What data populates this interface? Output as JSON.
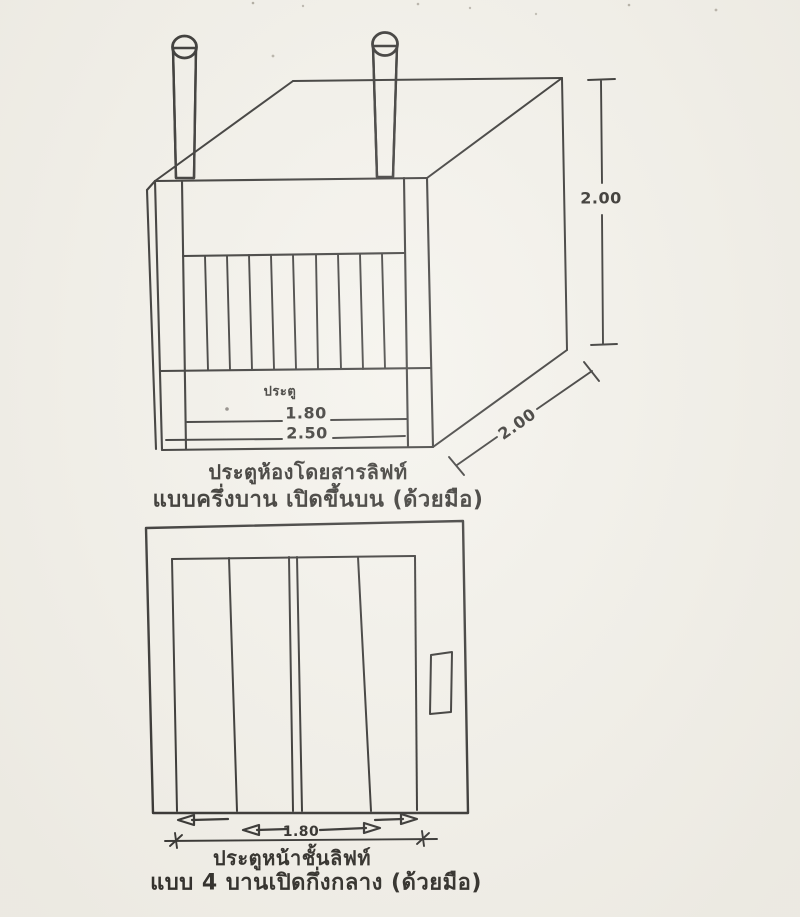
{
  "page": {
    "paper_color": "#f3f1ea",
    "ink_color": "#2b2a28"
  },
  "figures": {
    "cabin": {
      "id": "elevator-car-door-perspective",
      "labels": {
        "door": "ประตู"
      },
      "dimensions": {
        "opening_width": "1.80",
        "overall_width": "2.50",
        "height": "2.00",
        "depth": "2.00"
      },
      "caption": {
        "line1": "ประตูห้องโดยสารลิฟท์",
        "line2": "แบบครึ่งบาน เปิดขึ้นบน (ด้วยมือ)"
      }
    },
    "landing": {
      "id": "elevator-landing-door-front",
      "dimensions": {
        "opening_width": "1.80"
      },
      "caption": {
        "line1": "ประตูหน้าชั้นลิฟท์",
        "line2": "แบบ 4 บานเปิดกึ่งกลาง (ด้วยมือ)"
      }
    }
  }
}
